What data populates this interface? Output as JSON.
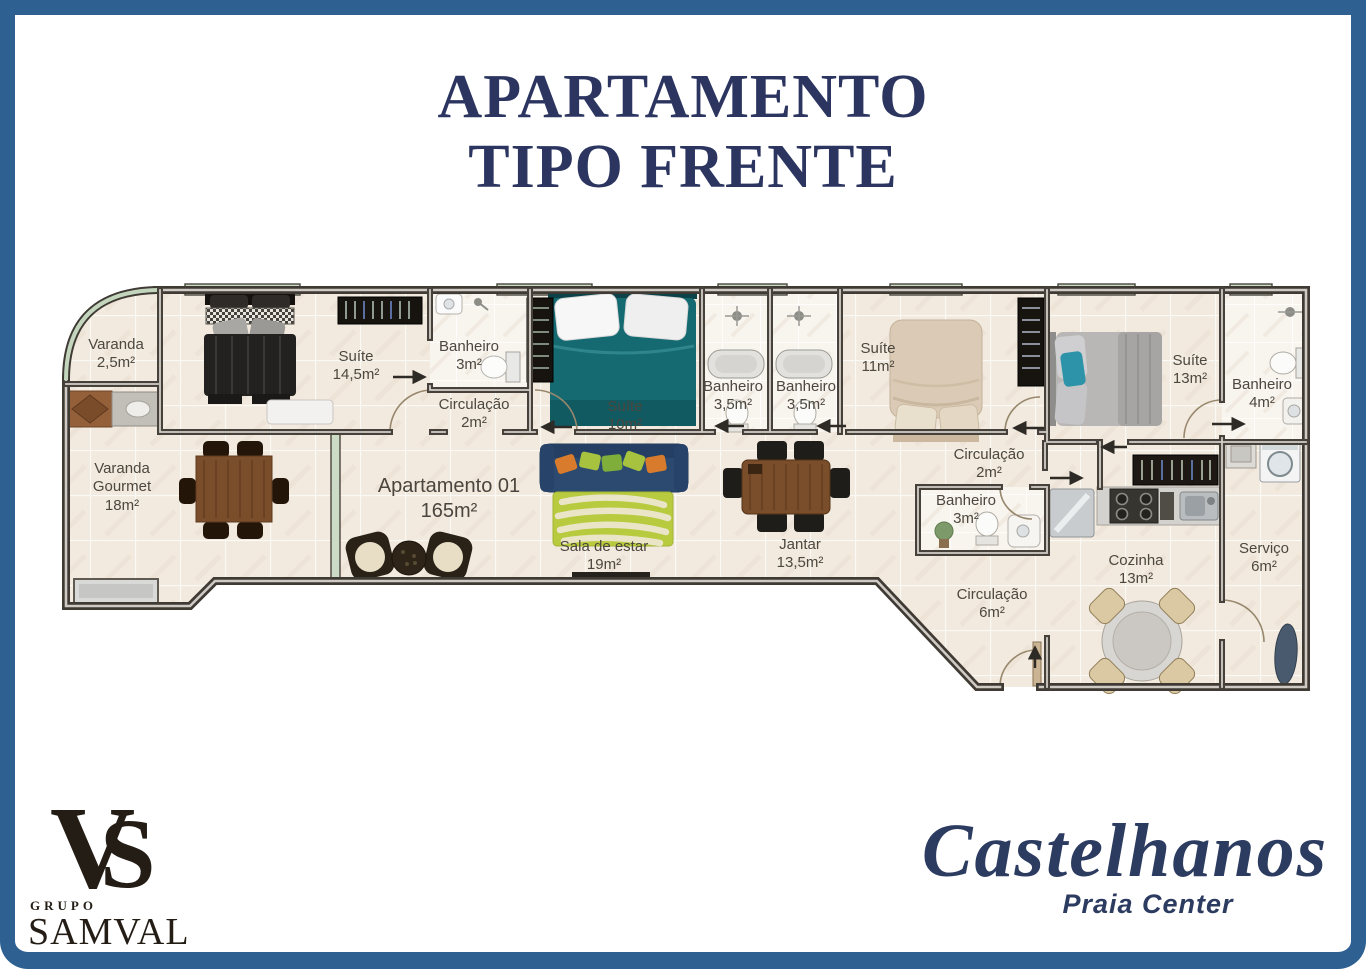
{
  "header": {
    "title_line1": "APARTAMENTO",
    "title_line2": "TIPO FRENTE"
  },
  "plan": {
    "apartment": {
      "name": "Apartamento 01",
      "area": "165m²"
    },
    "rooms": [
      {
        "name": "Varanda",
        "area": "2,5m²"
      },
      {
        "name": "Suíte",
        "area": "14,5m²"
      },
      {
        "name": "Banheiro",
        "area": "3m²"
      },
      {
        "name": "Circulação",
        "area": "2m²"
      },
      {
        "name": "Suíte",
        "area": "10m²"
      },
      {
        "name": "Banheiro",
        "area": "3,5m²"
      },
      {
        "name": "Banheiro",
        "area": "3,5m²"
      },
      {
        "name": "Suíte",
        "area": "11m²"
      },
      {
        "name": "Suíte",
        "area": "13m²"
      },
      {
        "name": "Banheiro",
        "area": "4m²"
      },
      {
        "name": "Varanda Gourmet",
        "area": "18m²"
      },
      {
        "name": "Sala de estar",
        "area": "19m²"
      },
      {
        "name": "Jantar",
        "area": "13,5m²"
      },
      {
        "name": "Banheiro",
        "area": "3m²"
      },
      {
        "name": "Circulação",
        "area": "2m²"
      },
      {
        "name": "Circulação",
        "area": "6m²"
      },
      {
        "name": "Cozinha",
        "area": "13m²"
      },
      {
        "name": "Serviço",
        "area": "6m²"
      }
    ]
  },
  "branding": {
    "samval": {
      "group_label": "GRUPO",
      "name": "SAMVAL",
      "monogram_v": "V",
      "monogram_s": "S"
    },
    "project": {
      "name": "Castelhanos",
      "subtitle": "Praia Center"
    }
  },
  "colors": {
    "frame": "#2e6191",
    "title": "#2b3560",
    "wall": "#3f3a34",
    "floor": "#f2eade",
    "glass": "#ccdbc5"
  }
}
